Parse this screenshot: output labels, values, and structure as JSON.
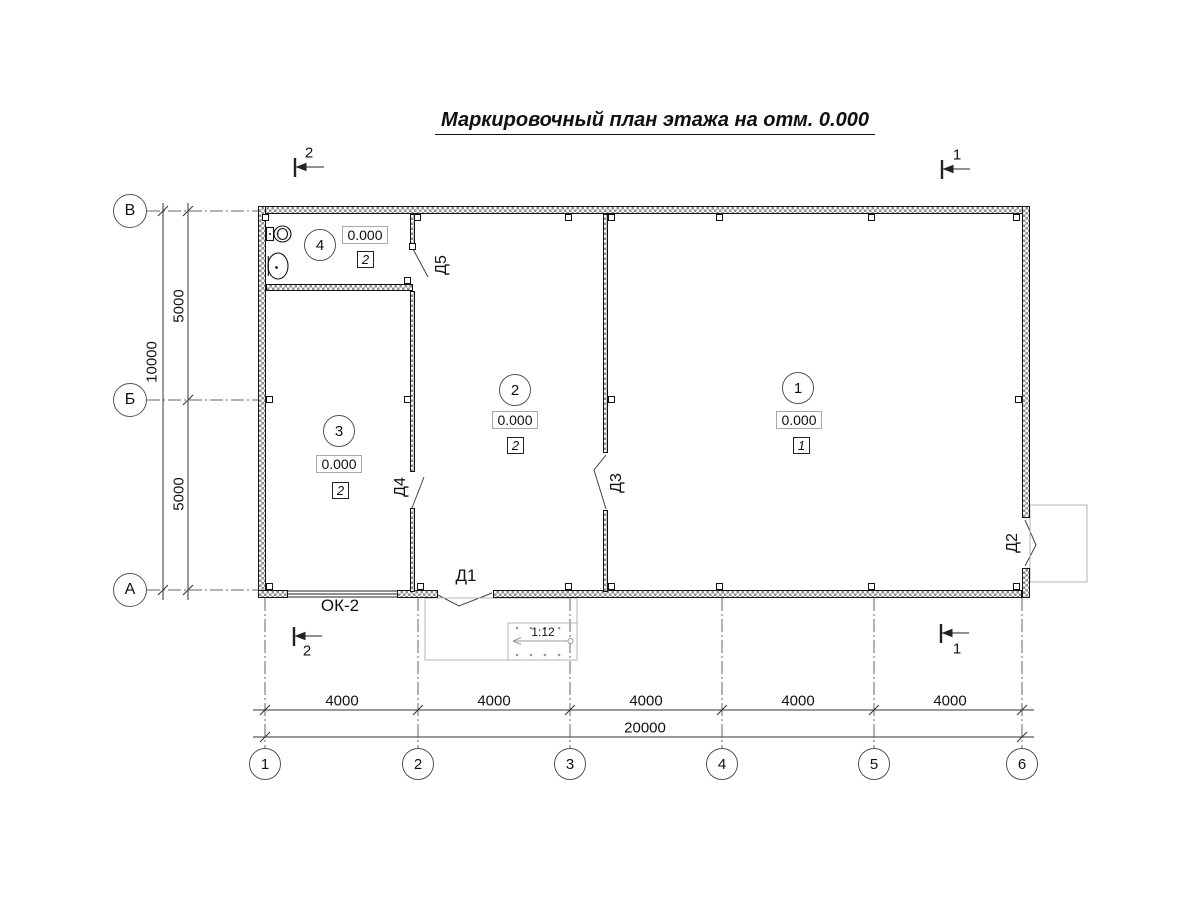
{
  "title": "Маркировочный план этажа на отм. 0.000",
  "rooms": {
    "r1": {
      "number": "1",
      "elevation": "0.000",
      "finish": "1"
    },
    "r2": {
      "number": "2",
      "elevation": "0.000",
      "finish": "2"
    },
    "r3": {
      "number": "3",
      "elevation": "0.000",
      "finish": "2"
    },
    "r4": {
      "number": "4",
      "elevation": "0.000",
      "finish": "2"
    }
  },
  "doors": {
    "d1": "Д1",
    "d2": "Д2",
    "d3": "Д3",
    "d4": "Д4",
    "d5": "Д5"
  },
  "window": {
    "label": "ОК-2"
  },
  "ramp": {
    "slope": "1:12"
  },
  "sections": {
    "s1": "1",
    "s2": "2"
  },
  "axes": {
    "bottom": [
      "1",
      "2",
      "3",
      "4",
      "5",
      "6"
    ],
    "left": [
      "В",
      "Б",
      "А"
    ]
  },
  "dimensions": {
    "bottom_segments": [
      "4000",
      "4000",
      "4000",
      "4000",
      "4000"
    ],
    "bottom_total": "20000",
    "left_segments": [
      "5000",
      "5000"
    ],
    "left_total": "10000"
  },
  "colors": {
    "wall_hatch": "#8f8f8f",
    "line": "#333333",
    "aux": "#b4b4b4"
  }
}
